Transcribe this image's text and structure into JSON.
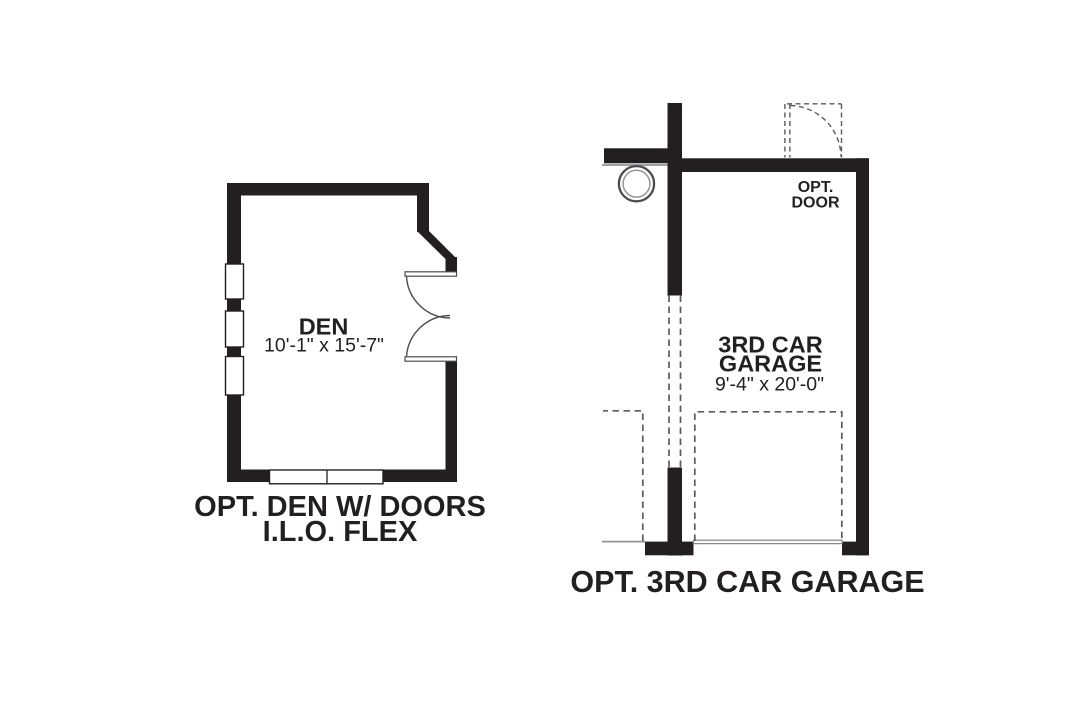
{
  "colors": {
    "wall": "#231f20",
    "text": "#231f20",
    "dash": "#5a5b5d",
    "thin-line": "#939598",
    "arc": "#4d4d4f",
    "background": "#ffffff"
  },
  "den_plan": {
    "room_label": "DEN",
    "room_dimensions": "10'-1\" x 15'-7\"",
    "caption_line1": "OPT. DEN W/ DOORS",
    "caption_line2": "I.L.O. FLEX"
  },
  "garage_plan": {
    "door_label_line1": "OPT.",
    "door_label_line2": "DOOR",
    "room_label_line1": "3RD CAR",
    "room_label_line2": "GARAGE",
    "room_dimensions": "9'-4\" x 20'-0\"",
    "caption": "OPT. 3RD CAR GARAGE"
  }
}
